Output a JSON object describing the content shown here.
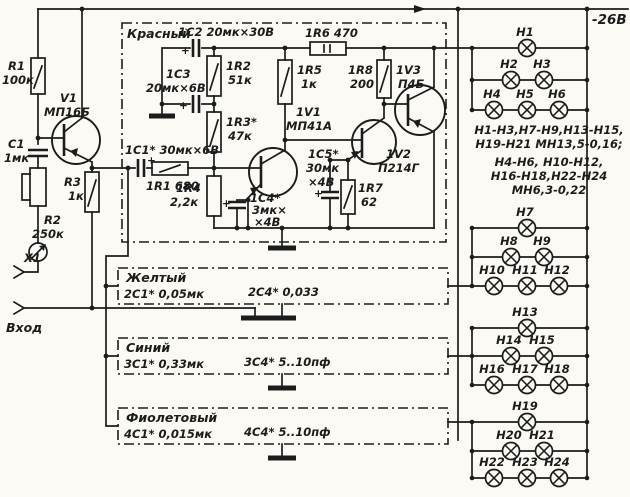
{
  "power": {
    "rail_label": "-26В"
  },
  "symbols": {
    "plus": "+"
  },
  "input_stage": {
    "r1_name": "R1",
    "r1_value": "100к",
    "v1_name": "V1",
    "v1_value": "МП16Б",
    "c1_name": "C1",
    "c1_value": "1мк",
    "r3_name": "R3",
    "r3_value": "1к",
    "r2_name": "R2",
    "r2_value": "250к",
    "x1_name": "X1",
    "input_label": "Вход"
  },
  "red_channel": {
    "title": "Красный",
    "c2_label": "1C2 20мк×30В",
    "c3_name": "1C3",
    "c3_value": "20мк×6В",
    "r2_name": "1R2",
    "r2_value": "51к",
    "r3_name": "1R3*",
    "r3_value": "47к",
    "c1_label": "1C1* 30мк×6В",
    "r1_label": "1R1 680",
    "r4_name": "1R4",
    "r4_value": "2,2к",
    "v1_name": "1V1",
    "v1_value": "МП41А",
    "c4_line1": "1C4*",
    "c4_line2": "3мк×",
    "c4_line3": "×4В",
    "r5_name": "1R5",
    "r5_value": "1к",
    "r6_label": "1R6 470",
    "c5_line1": "1C5*",
    "c5_line2": "30мк",
    "c5_line3": "×4В",
    "r7_name": "1R7",
    "r7_value": "62",
    "r8_name": "1R8",
    "r8_value": "200",
    "v2_name": "1V2",
    "v2_value": "П214Г",
    "v3_name": "1V3",
    "v3_value": "П4Б"
  },
  "yellow_channel": {
    "title": "Желтый",
    "c1_label": "2C1* 0,05мк",
    "c4_label": "2C4* 0,033"
  },
  "blue_channel": {
    "title": "Синий",
    "c1_label": "3C1* 0,33мк",
    "c4_label": "3C4* 5..10пф"
  },
  "violet_channel": {
    "title": "Фиолетовый",
    "c1_label": "4C1* 0,015мк",
    "c4_label": "4C4* 5..10пф"
  },
  "lamp_note": {
    "lines": [
      "Н1-Н3,Н7-Н9,Н13-Н15,",
      "Н19-Н21 МН13,5-0,16;",
      "Н4-Н6, Н10-Н12,",
      "Н16-Н18,Н22-Н24",
      "МН6,3-0,22"
    ]
  },
  "lamp_groups": [
    {
      "rows": [
        [
          "Н1"
        ],
        [
          "Н2",
          "Н3"
        ],
        [
          "Н4",
          "Н5",
          "Н6"
        ]
      ]
    },
    {
      "rows": [
        [
          "Н7"
        ],
        [
          "Н8",
          "Н9"
        ],
        [
          "Н10",
          "Н11",
          "Н12"
        ]
      ]
    },
    {
      "rows": [
        [
          "Н13"
        ],
        [
          "Н14",
          "Н15"
        ],
        [
          "Н16",
          "Н17",
          "Н18"
        ]
      ]
    },
    {
      "rows": [
        [
          "Н19"
        ],
        [
          "Н20",
          "Н21"
        ],
        [
          "Н22",
          "Н23",
          "Н24"
        ]
      ]
    }
  ],
  "colors": {
    "ink": "#1c1c1c",
    "paper": "#fbfaf4"
  }
}
